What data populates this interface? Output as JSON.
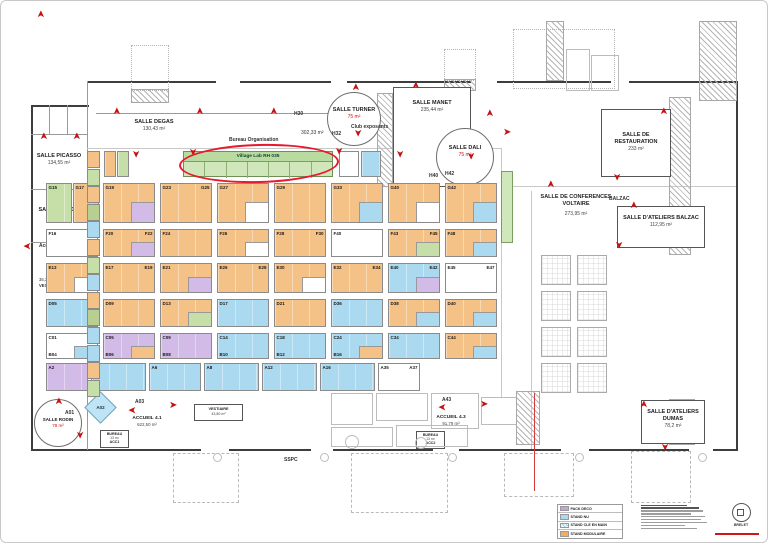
{
  "colors": {
    "or": "#f4c186",
    "bl": "#abd9ef",
    "pu": "#d3bbe7",
    "gr": "#c6dfa9",
    "ol": "#b9cf92",
    "wh": "#ffffff"
  },
  "icons": {
    "arrow_glyph": "➤"
  },
  "annotation": {
    "highlight": "red-ellipse-around-village-lab-rh"
  },
  "village": {
    "title": "Village Lab RH  035",
    "cells": 7
  },
  "rooms": {
    "picasso": {
      "name": "SALLE PICASSO",
      "area": "134,55 m²"
    },
    "renoir": {
      "name": "SALLE RENOIR",
      "area": "134,44 m²"
    },
    "degas": {
      "name": "SALLE DEGAS",
      "area": "130,43 m²"
    },
    "turner": {
      "name": "SALLE TURNER",
      "area": "75 m²"
    },
    "manet": {
      "name": "SALLE MANET",
      "area": "235,44 m²"
    },
    "dali": {
      "name": "SALLE DALI",
      "area": "75 m²"
    },
    "restauration": {
      "name": "SALLE DE RESTAURATION",
      "area": "233 m²"
    },
    "voltaire": {
      "name": "SALLE DE CONFERENCES\nVOLTAIRE",
      "area": "273,95 m²"
    },
    "atelier_balzac": {
      "name": "SALLE D'ATELIERS BALZAC",
      "area": "112,95 m²"
    },
    "dumas": {
      "name": "SALLE D'ATELIERS DUMAS",
      "area": "78,2 m²"
    },
    "rodin": {
      "name": "SALLE RODIN",
      "area": "78 m²"
    },
    "accueil41": {
      "name": "ACCUEIL 4.1",
      "area": "622,50 m²"
    },
    "accueil43": {
      "name": "ACCUEIL 4.3",
      "area": "91,79 m²"
    },
    "bureau1": {
      "name": "BUREAU",
      "area": "13 m²",
      "code": "ACC1"
    },
    "bureau2": {
      "name": "BUREAU",
      "area": "13 m²",
      "code": "ACC2"
    },
    "vestiaire2": {
      "name": "VESTIAIRE",
      "area": "43,80 m²"
    }
  },
  "labels": {
    "club": "Club exposants",
    "bureau_org": "Bureau Organisation",
    "hall_area": "302,33 m²",
    "balzac": "BALZAC",
    "accueil": "Accueil",
    "vestiaire_area": "35,38 m²",
    "vestiaire_name": "VESTIAIRE",
    "sspc": "SSPC",
    "h30": "H30",
    "h32": "H32",
    "h40": "H40",
    "h42": "H42",
    "a01": "A01",
    "a02": "A02",
    "a03": "A03",
    "a43": "A43"
  },
  "legend": {
    "items": [
      {
        "color": "#c9a0e0",
        "hatch": false,
        "label": "PACK DECO"
      },
      {
        "color": "#abd9ef",
        "hatch": false,
        "label": "STAND NU"
      },
      {
        "color": "#eaf6fb",
        "hatch": true,
        "label": "STAND CLE EN MAIN"
      },
      {
        "color": "#f4ab66",
        "hatch": false,
        "label": "STAND MODULAIRE"
      }
    ]
  },
  "stamp": "BRELET",
  "arrows": [
    [
      37,
      8,
      "u"
    ],
    [
      113,
      105,
      "u"
    ],
    [
      196,
      105,
      "u"
    ],
    [
      270,
      105,
      "u"
    ],
    [
      352,
      81,
      "u"
    ],
    [
      412,
      79,
      "u"
    ],
    [
      40,
      130,
      "u"
    ],
    [
      73,
      130,
      "u"
    ],
    [
      22,
      239,
      "l"
    ],
    [
      130,
      148,
      "d"
    ],
    [
      187,
      146,
      "d"
    ],
    [
      333,
      145,
      "d"
    ],
    [
      352,
      127,
      "d"
    ],
    [
      394,
      148,
      "d"
    ],
    [
      465,
      150,
      "d"
    ],
    [
      486,
      107,
      "u"
    ],
    [
      502,
      127,
      "r"
    ],
    [
      660,
      105,
      "u"
    ],
    [
      611,
      171,
      "d"
    ],
    [
      547,
      178,
      "u"
    ],
    [
      630,
      199,
      "u"
    ],
    [
      613,
      239,
      "d"
    ],
    [
      55,
      395,
      "u"
    ],
    [
      74,
      429,
      "d"
    ],
    [
      127,
      403,
      "l"
    ],
    [
      168,
      400,
      "r"
    ],
    [
      437,
      400,
      "l"
    ],
    [
      479,
      399,
      "r"
    ],
    [
      640,
      398,
      "u"
    ],
    [
      659,
      441,
      "d"
    ]
  ],
  "left_column": {
    "x": 86,
    "y": 150,
    "w": 13,
    "cell_h": 17.6,
    "cells": [
      "or",
      "gr",
      "or",
      "ol",
      "bl",
      "or",
      "gr",
      "bl",
      "or",
      "ol",
      "bl",
      "bl",
      "or",
      "gr"
    ]
  },
  "booth_rows": [
    {
      "y": 150,
      "h": 26,
      "booths": [
        {
          "x": 103,
          "w": 12,
          "c": "or"
        },
        {
          "x": 116,
          "w": 12,
          "c": "gr"
        },
        {
          "x": 338,
          "w": 20,
          "c": "wh"
        },
        {
          "x": 360,
          "w": 20,
          "c": "bl"
        }
      ]
    },
    {
      "y": 182,
      "h": 40,
      "booths": [
        {
          "x": 45,
          "w": 26,
          "c": "gr",
          "code": "G15"
        },
        {
          "x": 72,
          "w": 26,
          "c": "or",
          "code": "G17"
        },
        {
          "x": 102,
          "w": 52,
          "c": "or",
          "code": "G19",
          "p2": "pu"
        },
        {
          "x": 159,
          "w": 52,
          "c": "or",
          "code": "G23",
          "code2": "G25"
        },
        {
          "x": 216,
          "w": 52,
          "c": "or",
          "code": "G27",
          "p2": "wh"
        },
        {
          "x": 273,
          "w": 52,
          "c": "or",
          "code": "G29"
        },
        {
          "x": 330,
          "w": 52,
          "c": "or",
          "code": "G33",
          "p2": "bl"
        },
        {
          "x": 387,
          "w": 52,
          "c": "or",
          "code": "G40",
          "p2": "wh"
        },
        {
          "x": 444,
          "w": 52,
          "c": "or",
          "code": "G42",
          "p2": "bl"
        }
      ]
    },
    {
      "y": 228,
      "h": 28,
      "booths": [
        {
          "x": 45,
          "w": 52,
          "c": "wh",
          "code": "F16",
          "code2": "F18"
        },
        {
          "x": 102,
          "w": 52,
          "c": "or",
          "code": "F20",
          "code2": "F22",
          "p2": "pu"
        },
        {
          "x": 159,
          "w": 52,
          "c": "or",
          "code": "F24"
        },
        {
          "x": 216,
          "w": 52,
          "c": "or",
          "code": "F26",
          "p2": "wh"
        },
        {
          "x": 273,
          "w": 52,
          "c": "or",
          "code": "F28",
          "code2": "F30"
        },
        {
          "x": 330,
          "w": 52,
          "c": "wh",
          "code": "F40"
        },
        {
          "x": 387,
          "w": 52,
          "c": "or",
          "code": "F43",
          "code2": "F45",
          "p2": "gr"
        },
        {
          "x": 444,
          "w": 52,
          "c": "or",
          "code": "F48",
          "p2": "bl"
        }
      ]
    },
    {
      "y": 262,
      "h": 30,
      "booths": [
        {
          "x": 45,
          "w": 52,
          "c": "or",
          "code": "E13",
          "code2": "E15",
          "p2": "wh"
        },
        {
          "x": 102,
          "w": 52,
          "c": "or",
          "code": "E17",
          "code2": "E19"
        },
        {
          "x": 159,
          "w": 52,
          "c": "or",
          "code": "E21",
          "p2": "pu"
        },
        {
          "x": 216,
          "w": 52,
          "c": "or",
          "code": "E26",
          "code2": "E28"
        },
        {
          "x": 273,
          "w": 52,
          "c": "or",
          "code": "E30",
          "p2": "wh"
        },
        {
          "x": 330,
          "w": 52,
          "c": "or",
          "code": "E32",
          "code2": "E34"
        },
        {
          "x": 387,
          "w": 52,
          "c": "bl",
          "code": "E40",
          "code2": "E42",
          "p2": "pu"
        },
        {
          "x": 444,
          "w": 52,
          "c": "wh",
          "code": "E45",
          "code2": "E47"
        }
      ]
    },
    {
      "y": 298,
      "h": 28,
      "booths": [
        {
          "x": 45,
          "w": 52,
          "c": "bl",
          "code": "D05"
        },
        {
          "x": 102,
          "w": 52,
          "c": "or",
          "code": "D09"
        },
        {
          "x": 159,
          "w": 52,
          "c": "or",
          "code": "D13",
          "p2": "gr"
        },
        {
          "x": 216,
          "w": 52,
          "c": "bl",
          "code": "D17"
        },
        {
          "x": 273,
          "w": 52,
          "c": "or",
          "code": "D21"
        },
        {
          "x": 330,
          "w": 52,
          "c": "bl",
          "code": "D36"
        },
        {
          "x": 387,
          "w": 52,
          "c": "or",
          "code": "D38",
          "p2": "bl"
        },
        {
          "x": 444,
          "w": 52,
          "c": "or",
          "code": "D40",
          "p2": "bl"
        }
      ]
    },
    {
      "y": 332,
      "h": 26,
      "booths": [
        {
          "x": 45,
          "w": 52,
          "c": "wh",
          "code": "C01",
          "b": "B04",
          "p2": "bl"
        },
        {
          "x": 102,
          "w": 52,
          "c": "pu",
          "code": "C05",
          "b": "B06",
          "p2": "or"
        },
        {
          "x": 159,
          "w": 52,
          "c": "pu",
          "code": "C09",
          "b": "B08"
        },
        {
          "x": 216,
          "w": 52,
          "c": "bl",
          "code": "C14",
          "b": "B10"
        },
        {
          "x": 273,
          "w": 52,
          "c": "bl",
          "code": "C18",
          "b": "B12"
        },
        {
          "x": 330,
          "w": 52,
          "c": "bl",
          "code": "C24",
          "b": "B16",
          "p2": "or"
        },
        {
          "x": 387,
          "w": 52,
          "c": "bl",
          "code": "C34"
        },
        {
          "x": 444,
          "w": 52,
          "c": "or",
          "code": "C44",
          "p2": "bl"
        }
      ]
    },
    {
      "y": 362,
      "h": 28,
      "booths": [
        {
          "x": 45,
          "w": 42,
          "c": "pu",
          "code": "A2"
        },
        {
          "x": 90,
          "w": 55,
          "c": "bl",
          "code": "A4"
        },
        {
          "x": 148,
          "w": 52,
          "c": "bl",
          "code": "A6"
        },
        {
          "x": 203,
          "w": 55,
          "c": "bl",
          "code": "A8"
        },
        {
          "x": 261,
          "w": 55,
          "c": "bl",
          "code": "A12"
        },
        {
          "x": 319,
          "w": 55,
          "c": "bl",
          "code": "A16"
        },
        {
          "x": 377,
          "w": 42,
          "c": "wh",
          "code": "A35",
          "code2": "A37"
        }
      ]
    }
  ]
}
